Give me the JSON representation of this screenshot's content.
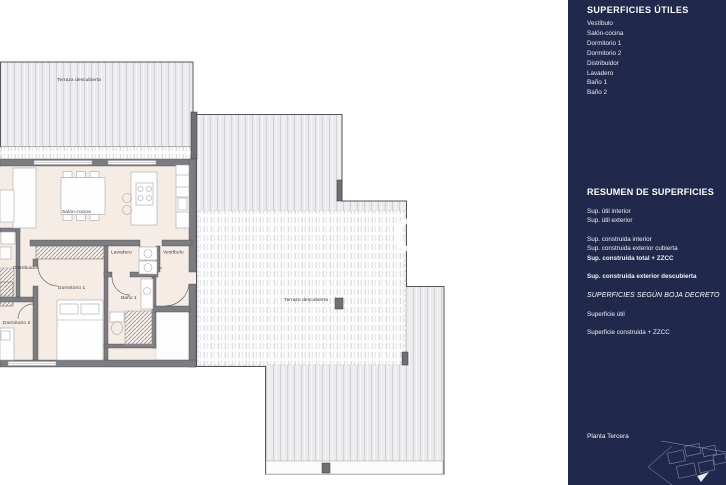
{
  "colors": {
    "sidebar_bg": "#20284b",
    "floor_fill": "#f6ece6",
    "wall_fill": "#7d7d81",
    "terrace_fill": "#ebebed",
    "terrace_stripe": "#d3d3d6"
  },
  "plan": {
    "room_labels": {
      "terraza_top": "Terraza descubierta",
      "salon_cocina": "Salón-cocina",
      "distribuidor": "Distribuidor",
      "lavadero": "Lavadero",
      "vestibulo": "Vestíbulo",
      "dormitorio_1": "Dormitorio 1",
      "dormitorio_2": "Dormitorio 2",
      "bano_1": "Baño 1",
      "terraza_main": "Terraza descubierta"
    }
  },
  "watermark": {
    "text": "CE"
  },
  "sidebar": {
    "superficies_utiles": {
      "title": "SUPERFICIES ÚTILES",
      "items": [
        "Vestíbulo",
        "Salón-cocina",
        "Dormitorio 1",
        "Dormitorio 2",
        "Distribuidor",
        "Lavadero",
        "Baño 1",
        "Baño 2"
      ]
    },
    "resumen": {
      "title": "RESUMEN  DE SUPERFICIES",
      "util_items": [
        "Sup. útil interior",
        "Sup. útil exterior"
      ],
      "construida_items": [
        "Sup. construida interior",
        "Sup. construida exterior cubierta"
      ],
      "construida_total": "Sup. construida total + ZZCC",
      "exterior_descubierta": "Sup. construida exterior descubierta"
    },
    "boja": {
      "title": "SUPERFICIES SEGÚN BOJA DECRETO",
      "items": [
        "Superficie útil",
        "Superficie construida + ZZCC"
      ]
    },
    "floor_label": "Planta Tercera"
  }
}
